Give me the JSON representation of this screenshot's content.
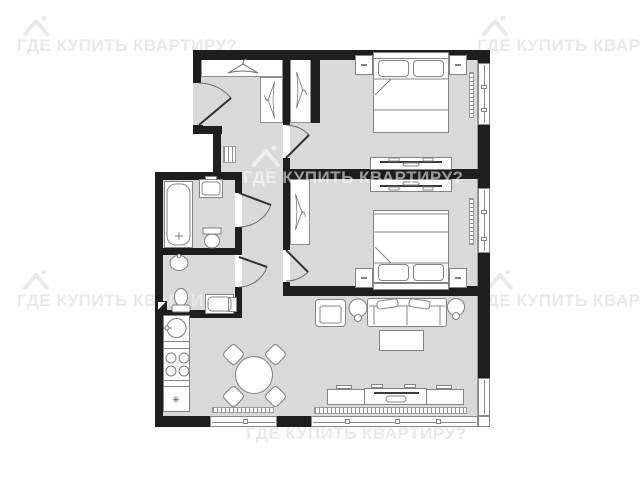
{
  "watermark": {
    "text": "ГДЕ КУПИТЬ КВАРТИРУ?"
  },
  "symbols": {
    "fridge": "✳"
  },
  "colors": {
    "wall": "#1e1e1e",
    "floor": "#d9d9d9",
    "furniture_outline": "#848484",
    "watermark_outside": "#e9e9e9",
    "watermark_inside": "rgba(255,255,255,0.55)"
  },
  "plan": {
    "type": "apartment-floor-plan-2-bedroom",
    "rooms": [
      {
        "name": "hallway",
        "items": [
          "entrance-door",
          "coat-rack",
          "hall-closet",
          "radiator-grille"
        ]
      },
      {
        "name": "bedroom-1",
        "items": [
          "double-bed",
          "two-pillows",
          "nightstand-left",
          "nightstand-right",
          "built-in-wardrobe",
          "tv-console",
          "window",
          "radiator"
        ]
      },
      {
        "name": "bedroom-2",
        "items": [
          "double-bed",
          "two-pillows",
          "nightstand-left",
          "nightstand-right",
          "wardrobe",
          "tv-console",
          "window",
          "radiator"
        ]
      },
      {
        "name": "bathroom",
        "items": [
          "bathtub",
          "cabinet",
          "toilet",
          "door"
        ]
      },
      {
        "name": "wc-laundry",
        "items": [
          "washbasin",
          "toilet",
          "washing-machine",
          "door",
          "shaft-marker"
        ]
      },
      {
        "name": "kitchen-dining",
        "items": [
          "sink",
          "stove-4-burners",
          "counter",
          "refrigerator",
          "round-dining-table",
          "chair",
          "chair",
          "chair",
          "chair",
          "window",
          "radiator"
        ]
      },
      {
        "name": "living-room",
        "items": [
          "sofa",
          "armchair",
          "side-table-lamp",
          "side-table-lamp",
          "coffee-table",
          "tv-stand",
          "tv",
          "window",
          "window",
          "radiator"
        ]
      }
    ]
  }
}
